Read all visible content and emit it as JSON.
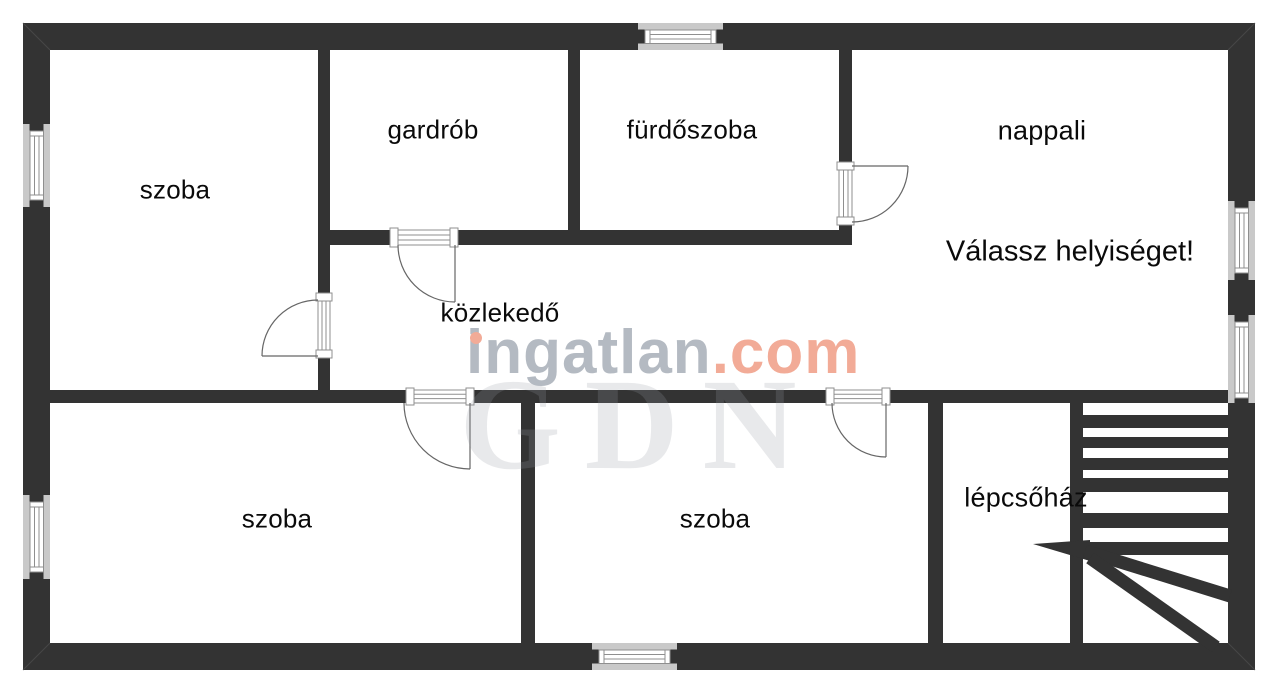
{
  "plan": {
    "prompt": "Válassz helyiséget!",
    "rooms": [
      {
        "id": "szoba-top-left",
        "label": "szoba"
      },
      {
        "id": "gardrob",
        "label": "gardrób"
      },
      {
        "id": "furdoszoba",
        "label": "fürdőszoba"
      },
      {
        "id": "nappali",
        "label": "nappali"
      },
      {
        "id": "kozlekedo",
        "label": "közlekedő"
      },
      {
        "id": "szoba-bottom-left",
        "label": "szoba"
      },
      {
        "id": "szoba-bottom-middle",
        "label": "szoba"
      },
      {
        "id": "lepcsohaz",
        "label": "lépcsőház"
      }
    ],
    "watermark": {
      "brand_gray_text": "ingatlan",
      "brand_accent_text": ".com",
      "background_text": "GDN"
    },
    "colors": {
      "wall": "#333333",
      "lintel": "#c9c9c9",
      "frame_line": "#8f8f8f",
      "door_arc": "#666666",
      "label": "#0a0a0a",
      "watermark_gray": "#b4bac2",
      "watermark_accent": "#f2ab97"
    }
  }
}
